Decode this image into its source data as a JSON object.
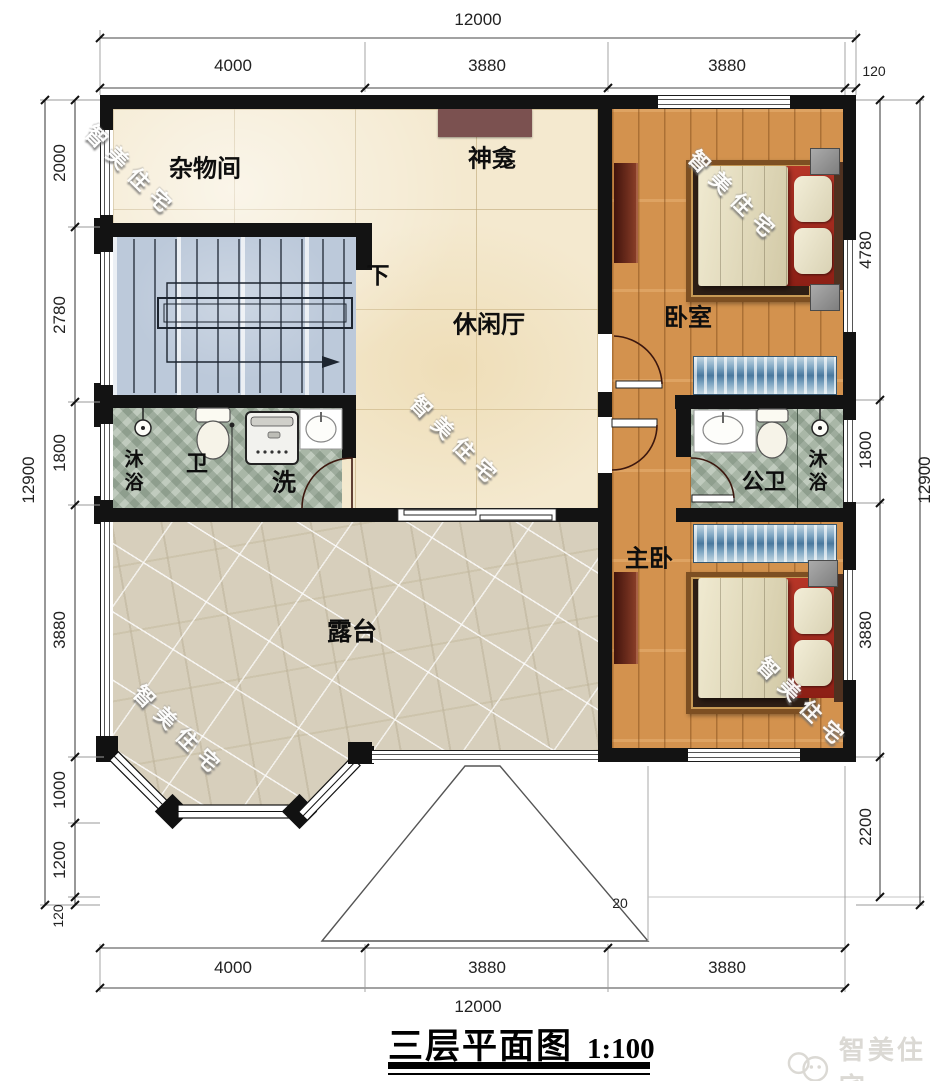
{
  "title": {
    "name": "三层平面图",
    "scale": "1:100"
  },
  "watermark_text": "智美住宅",
  "brand": {
    "logo_text": "智美住宅"
  },
  "rooms": {
    "storage": "杂物间",
    "shrine": "神龛",
    "lounge": "休闲厅",
    "stairs_down": "下",
    "bedroom": "卧室",
    "shower_left": "沐浴",
    "toilet_left": "卫",
    "wash": "洗",
    "public_bath": "公卫",
    "shower_right": "沐浴",
    "master_bedroom": "主卧",
    "terrace": "露台"
  },
  "dimensions": {
    "top": {
      "total": "12000",
      "segments": [
        "4000",
        "3880",
        "3880"
      ],
      "wall": "120"
    },
    "bottom": {
      "total": "12000",
      "segments": [
        "4000",
        "3880",
        "3880"
      ]
    },
    "left": {
      "total": "12900",
      "segments": [
        "2000",
        "2780",
        "1800",
        "3880",
        "1000",
        "1200",
        "120"
      ]
    },
    "right": {
      "total": "12900",
      "segments": [
        "4780",
        "1800",
        "3880",
        "2200"
      ]
    },
    "roof": "20"
  }
}
